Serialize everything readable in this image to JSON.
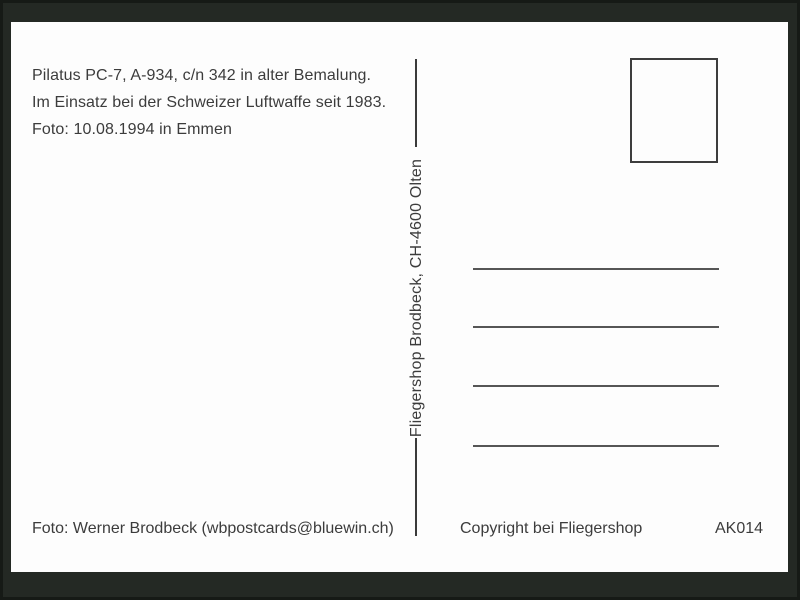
{
  "postcard": {
    "info_lines": [
      "Pilatus PC-7, A-934, c/n 342 in alter Bemalung.",
      "Im Einsatz bei der Schweizer Luftwaffe seit 1983.",
      "Foto: 10.08.1994 in Emmen"
    ],
    "publisher_vertical": "Fliegershop Brodbeck, CH-4600 Olten",
    "footer": {
      "photo_credit": "Foto: Werner Brodbeck (wbpostcards@bluewin.ch)",
      "copyright": "Copyright bei Fliegershop",
      "catalog_number": "AK014"
    },
    "address_lines_count": 4,
    "colors": {
      "frame": "#242924",
      "card": "#fdfdfd",
      "text": "#3c3c3c",
      "rule_line": "#565656",
      "stamp_border": "#3d3d3d"
    }
  }
}
